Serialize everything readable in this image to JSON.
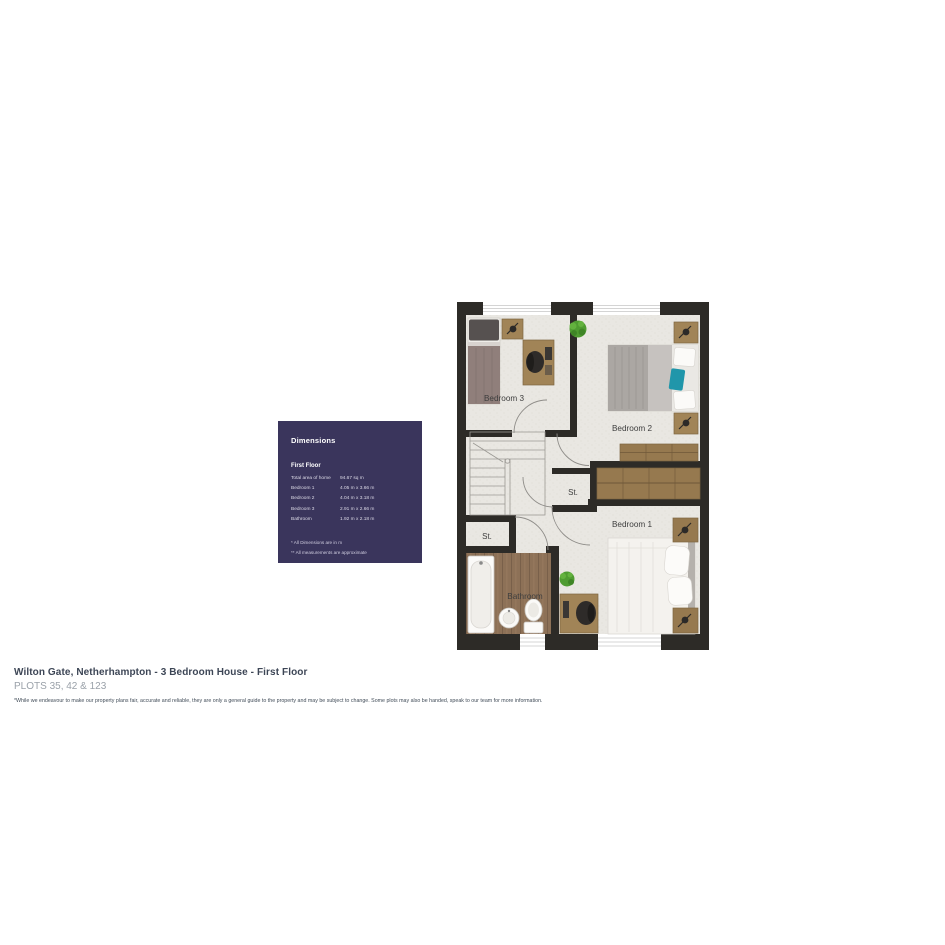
{
  "dimensions_panel": {
    "bg_color": "#3a355c",
    "title": "Dimensions",
    "section_title": "First Floor",
    "rows": [
      {
        "label": "Total area of home",
        "value": "94.67 sq m"
      },
      {
        "label": "Bedroom 1",
        "value": "4.05 m x 3.66 m"
      },
      {
        "label": "Bedroom 2",
        "value": "4.04 m x 3.18 m"
      },
      {
        "label": "Bedroom 3",
        "value": "2.91 m x 2.66 m"
      },
      {
        "label": "Bathroom",
        "value": "1.92 m x 2.18 m"
      }
    ],
    "footnotes": [
      "* All Dimensions are in m",
      "** All measurements are approximate"
    ]
  },
  "floor_plan": {
    "labels": {
      "bedroom3": "Bedroom 3",
      "bedroom2": "Bedroom 2",
      "bedroom1": "Bedroom 1",
      "storage_hall": "St.",
      "storage_left": "St.",
      "bathroom": "Bathroom"
    },
    "colors": {
      "wall": "#2d2b27",
      "floor": "#e9e7e2",
      "wood_furniture": "#a18457",
      "wood_floor": "#8d7157",
      "teal_accent": "#2096aa",
      "plant_green": "#4f9c31",
      "label_text": "#3e3e3e"
    }
  },
  "footer": {
    "title": "Wilton Gate, Netherhampton - 3 Bedroom House - First Floor",
    "subtitle": "PLOTS 35, 42 & 123",
    "disclaimer": "*While we endeavour to make our property plans fair, accurate and reliable, they are only a general guide to the property and may be subject to change. Some plots may also be handed, speak to our team for more information."
  }
}
